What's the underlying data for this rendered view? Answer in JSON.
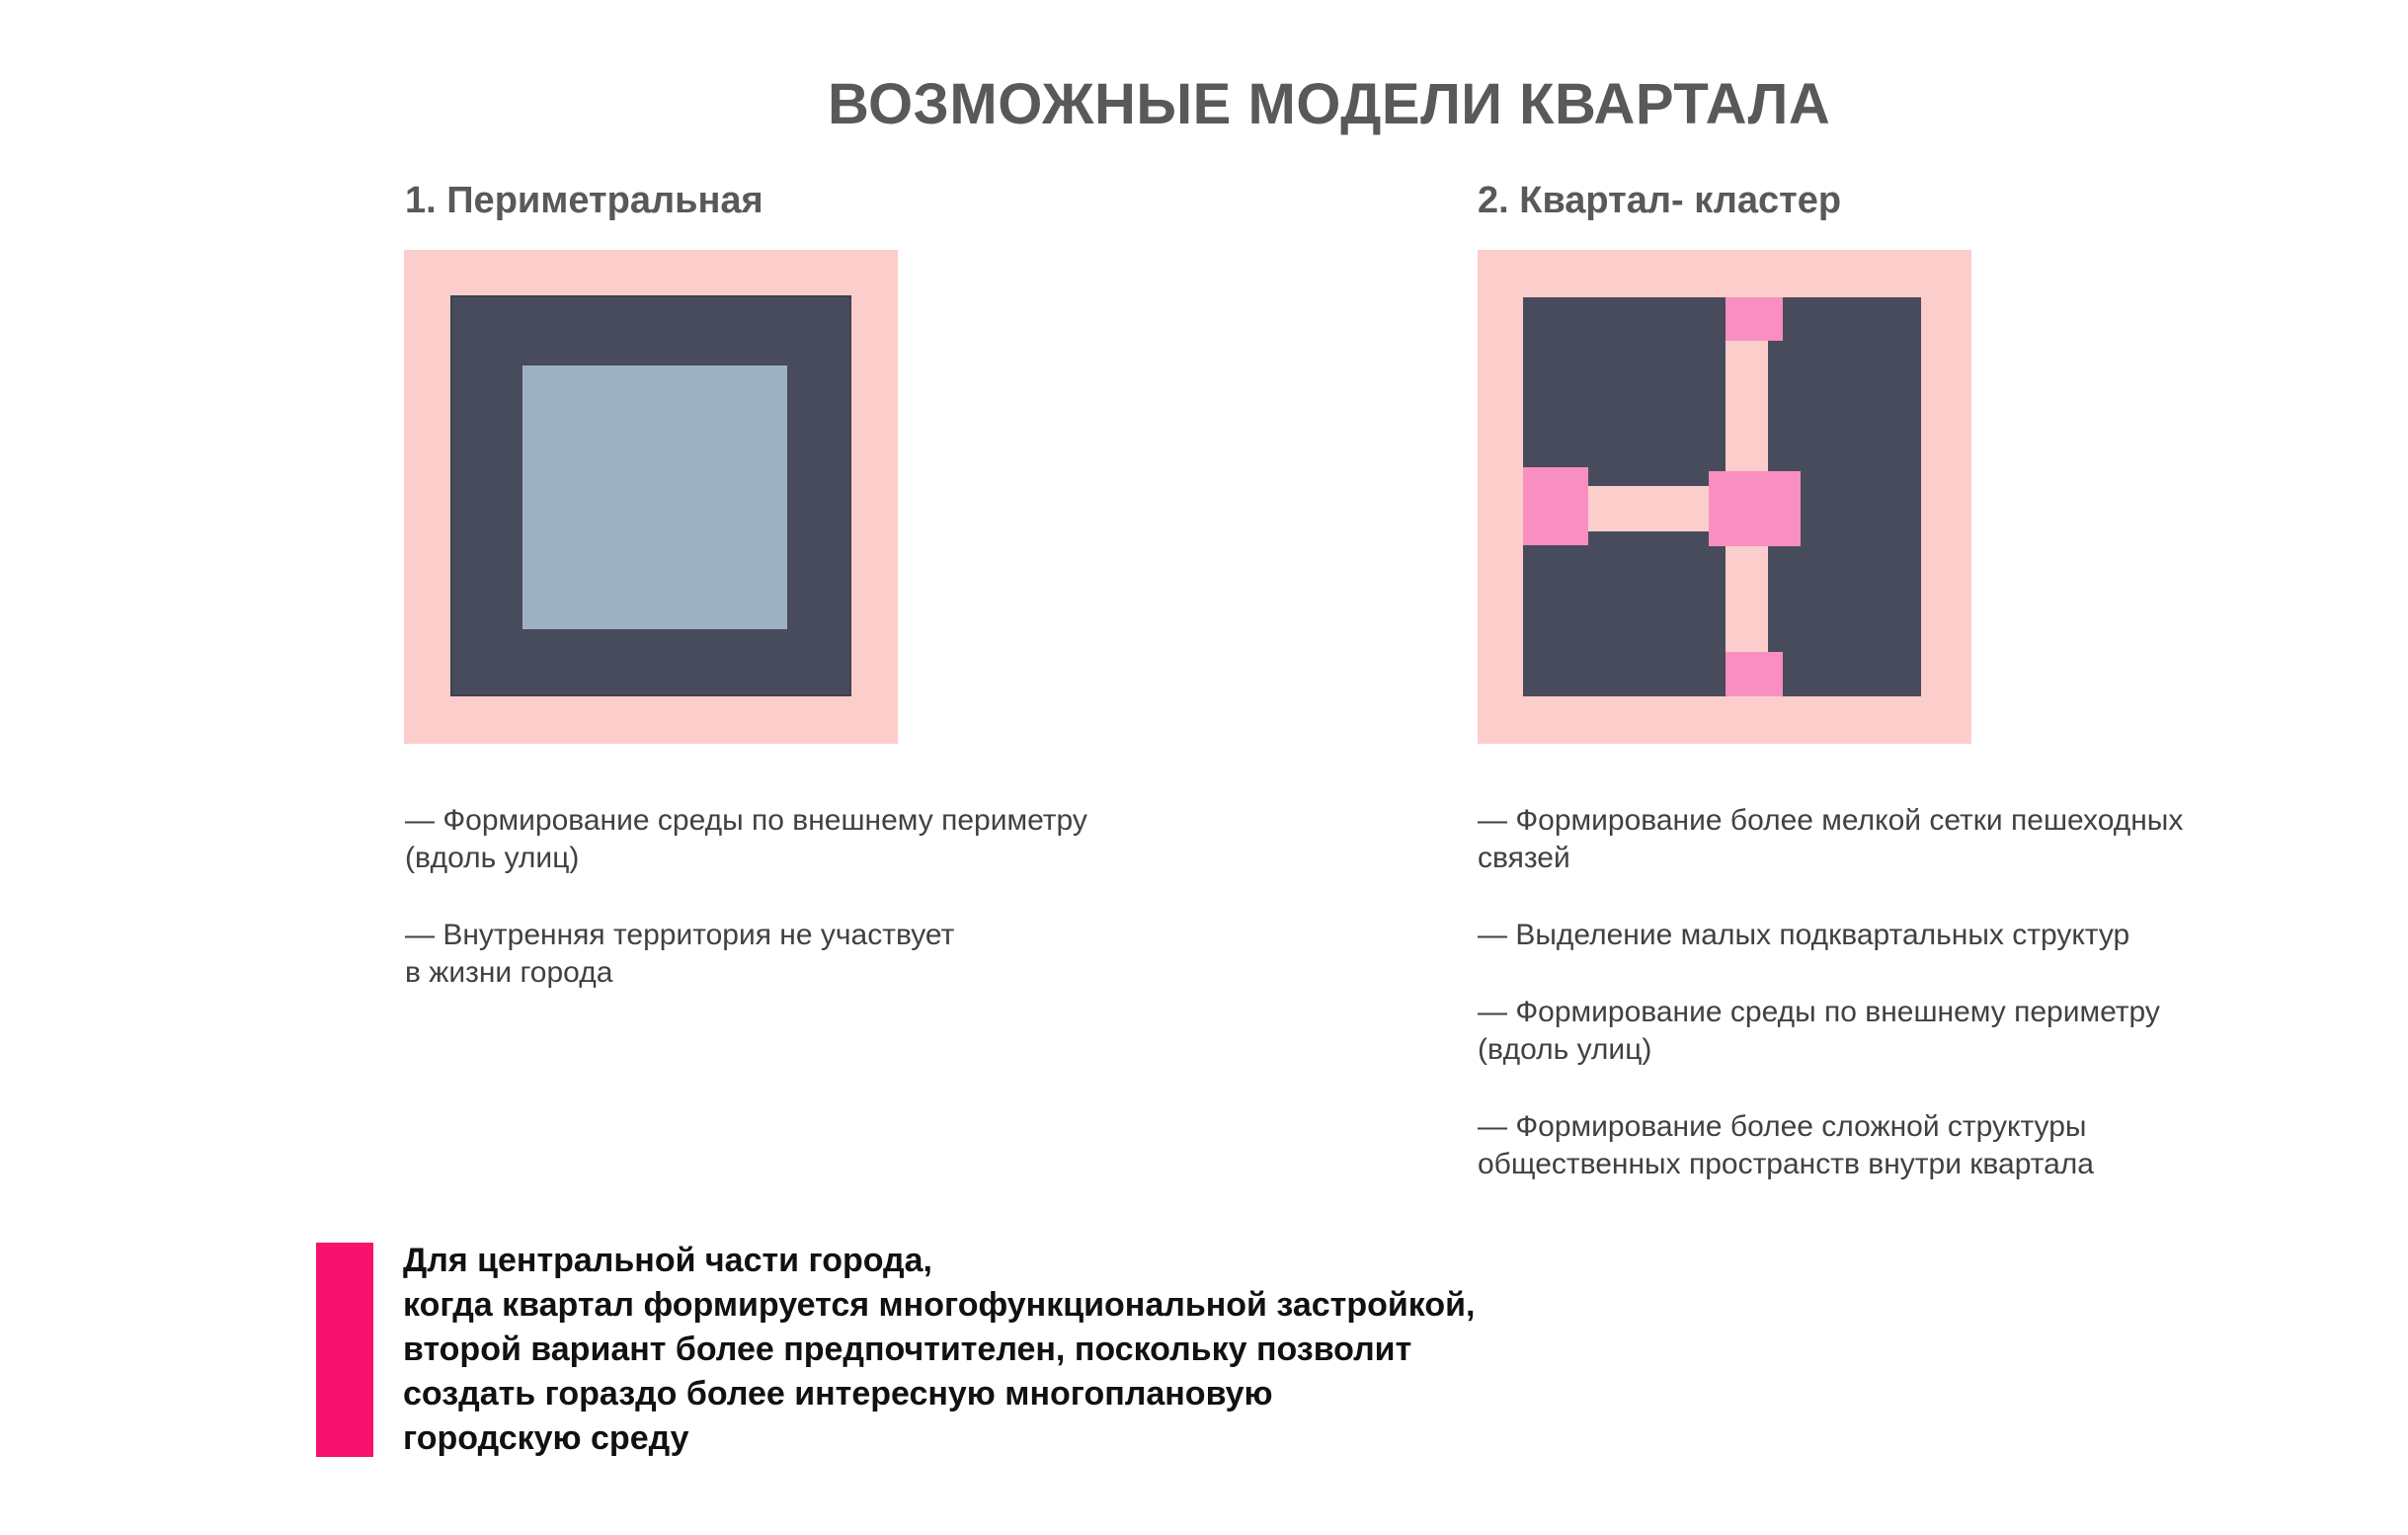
{
  "page": {
    "title": "ВОЗМОЖНЫЕ МОДЕЛИ КВАРТАЛА"
  },
  "colors": {
    "light_pink": "#fccecb",
    "dark_slate": "#474b5c",
    "courtyard_blue_gray": "#9eb1c3",
    "hot_pink_connector": "#f98ec0",
    "accent_magenta": "#f8126d",
    "heading_gray": "#58595b",
    "body_gray": "#414042"
  },
  "models": [
    {
      "heading": "1. Периметральная",
      "bullets": [
        "— Формирование среды по внешнему периметру\n(вдоль улиц)",
        "— Внутренняя территория не участвует\nв жизни города"
      ]
    },
    {
      "heading": "2. Квартал- кластер",
      "bullets": [
        "— Формирование более мелкой сетки пешеходных\nсвязей",
        "— Выделение малых подквартальных структур",
        "— Формирование среды по внешнему периметру\n(вдоль улиц)",
        "— Формирование более сложной структуры\nобщественных пространств внутри квартала"
      ]
    }
  ],
  "conclusion": {
    "text": "Для центральной части города,\nкогда квартал формируется многофункциональной застройкой,\nвторой вариант более предпочтителен, поскольку позволит\nсоздать гораздо более интересную многоплановую\nгородскую среду"
  }
}
